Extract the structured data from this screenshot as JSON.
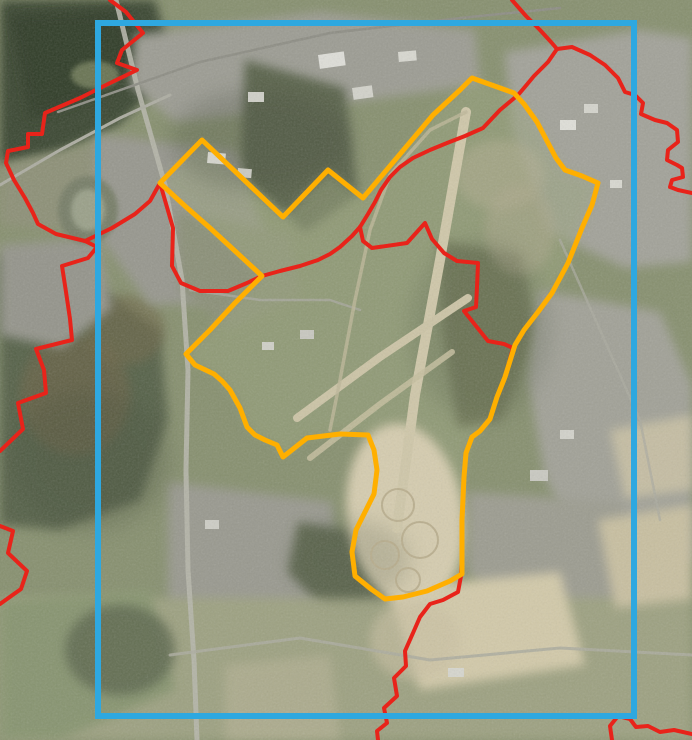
{
  "map": {
    "width": 692,
    "height": 740,
    "base_color": "#87906F",
    "palette": {
      "extent_frame_blue": "#2EA8E0",
      "site_boundary_orange": "#FFAF00",
      "municipal_boundary_red": "#E8231A"
    },
    "terrain_patches": [
      {
        "name": "water-lake",
        "kind": "polygon",
        "points": "0,0 155,0 168,45 150,95 118,125 60,152 0,165",
        "color": "#3A4733",
        "opacity": 1,
        "blur": "soft"
      },
      {
        "name": "water-dark",
        "kind": "polygon",
        "points": "10,15 120,10 140,60 100,95 30,120",
        "color": "#2E3A28",
        "opacity": 0.8,
        "blur": "soft"
      },
      {
        "name": "lake-island",
        "kind": "ellipse",
        "cx": 95,
        "cy": 75,
        "rx": 24,
        "ry": 14,
        "color": "#6F7A58",
        "opacity": 0.9,
        "blur": "slight"
      },
      {
        "name": "shore-strip",
        "kind": "polygon",
        "points": "0,165 70,150 130,135 180,160 150,215 60,230 0,225",
        "color": "#8D9077",
        "opacity": 1,
        "blur": "soft"
      },
      {
        "name": "forest-left",
        "kind": "polygon",
        "points": "0,255 95,285 160,330 168,420 140,500 60,530 0,525",
        "color": "#57624A",
        "opacity": 1,
        "blur": "soft"
      },
      {
        "name": "forest-left-brown",
        "kind": "ellipse",
        "cx": 75,
        "cy": 395,
        "rx": 55,
        "ry": 60,
        "color": "#6A6346",
        "opacity": 0.7,
        "blur": "soft"
      },
      {
        "name": "forest-left-brown-2",
        "kind": "ellipse",
        "cx": 125,
        "cy": 330,
        "rx": 40,
        "ry": 35,
        "color": "#70684A",
        "opacity": 0.6,
        "blur": "soft"
      },
      {
        "name": "industrial-top",
        "kind": "polygon",
        "points": "135,35 320,12 475,30 480,85 330,105 175,122 130,85",
        "color": "#9C9C93",
        "opacity": 1,
        "blur": "soft"
      },
      {
        "name": "town-top-right",
        "kind": "polygon",
        "points": "505,52 640,30 692,38 692,262 625,268 548,232 512,130",
        "color": "#A2A299",
        "opacity": 1,
        "blur": "soft"
      },
      {
        "name": "woods-center",
        "kind": "polygon",
        "points": "245,60 345,88 358,195 305,232 240,175",
        "color": "#5A644B",
        "opacity": 1,
        "blur": "soft"
      },
      {
        "name": "industrial-left-band",
        "kind": "polygon",
        "points": "95,135 235,150 265,235 235,302 150,305 98,235",
        "color": "#97978E",
        "opacity": 1,
        "blur": "soft"
      },
      {
        "name": "commercial-left-edge",
        "kind": "polygon",
        "points": "0,245 98,238 112,308 62,348 0,335",
        "color": "#94948B",
        "opacity": 1,
        "blur": "soft"
      },
      {
        "name": "oval-arena",
        "kind": "ellipse",
        "cx": 88,
        "cy": 210,
        "rx": 30,
        "ry": 34,
        "color": "#777E68",
        "opacity": 1,
        "blur": "slight"
      },
      {
        "name": "oval-arena-infield",
        "kind": "ellipse",
        "cx": 88,
        "cy": 210,
        "rx": 17,
        "ry": 21,
        "color": "#9AA089",
        "opacity": 1,
        "blur": "slight"
      },
      {
        "name": "barracks-area",
        "kind": "polygon",
        "points": "175,210 290,235 300,295 230,330 180,290",
        "color": "#8B9078",
        "opacity": 1,
        "blur": "soft"
      },
      {
        "name": "airfield-grass",
        "kind": "site-fill",
        "color": "#9AA47D",
        "opacity": 0.5,
        "blur": "soft"
      },
      {
        "name": "woods-east-strip",
        "kind": "polygon",
        "points": "438,240 520,255 538,330 502,420 458,428 442,330",
        "color": "#6F7757",
        "opacity": 0.85,
        "blur": "soft"
      },
      {
        "name": "clearing-ne",
        "kind": "ellipse",
        "cx": 500,
        "cy": 175,
        "rx": 45,
        "ry": 35,
        "color": "#B4AF92",
        "opacity": 0.5,
        "blur": "soft"
      },
      {
        "name": "clearing-ne-2",
        "kind": "ellipse",
        "cx": 520,
        "cy": 230,
        "rx": 35,
        "ry": 45,
        "color": "#ADA88C",
        "opacity": 0.5,
        "blur": "soft"
      },
      {
        "name": "suburb-east",
        "kind": "polygon",
        "points": "538,290 660,312 692,385 692,560 598,580 545,478 528,380",
        "color": "#A1A197",
        "opacity": 1,
        "blur": "soft"
      },
      {
        "name": "village-se",
        "kind": "polygon",
        "points": "468,492 622,502 640,598 520,628 468,572",
        "color": "#9C9C90",
        "opacity": 1,
        "blur": "soft"
      },
      {
        "name": "village-south",
        "kind": "polygon",
        "points": "168,482 332,502 342,640 228,662 168,602",
        "color": "#99998F",
        "opacity": 1,
        "blur": "soft"
      },
      {
        "name": "woods-south",
        "kind": "polygon",
        "points": "298,522 420,542 432,602 332,618 288,572",
        "color": "#5E684F",
        "opacity": 1,
        "blur": "soft"
      },
      {
        "name": "fields-bottom",
        "kind": "rect",
        "x": 0,
        "y": 598,
        "w": 692,
        "h": 142,
        "color": "#9DA181",
        "opacity": 1,
        "blur": "soft"
      },
      {
        "name": "field-pale-1",
        "kind": "polygon",
        "points": "388,588 560,572 585,665 420,690",
        "color": "#D2C9A9",
        "opacity": 1,
        "blur": "soft"
      },
      {
        "name": "field-pale-2",
        "kind": "polygon",
        "points": "598,520 692,505 692,600 615,608",
        "color": "#C8BFA0",
        "opacity": 1,
        "blur": "soft"
      },
      {
        "name": "field-pale-3",
        "kind": "polygon",
        "points": "610,430 692,415 692,490 625,498",
        "color": "#CEC5A6",
        "opacity": 0.8,
        "blur": "soft"
      },
      {
        "name": "field-green-bl",
        "kind": "polygon",
        "points": "0,600 150,590 175,690 60,740 0,740",
        "color": "#879470",
        "opacity": 1,
        "blur": "soft"
      },
      {
        "name": "woods-bl",
        "kind": "ellipse",
        "cx": 120,
        "cy": 650,
        "rx": 55,
        "ry": 45,
        "color": "#5C664D",
        "opacity": 0.8,
        "blur": "soft"
      },
      {
        "name": "field-pale-bl",
        "kind": "polygon",
        "points": "225,665 330,655 340,740 225,740",
        "color": "#B3B093",
        "opacity": 0.7,
        "blur": "soft"
      },
      {
        "name": "drop-zone",
        "kind": "ellipse",
        "cx": 405,
        "cy": 515,
        "rx": 58,
        "ry": 92,
        "rotate": -8,
        "color": "#D5CCAF",
        "opacity": 1,
        "blur": "soft"
      },
      {
        "name": "drop-zone-south",
        "kind": "ellipse",
        "cx": 415,
        "cy": 640,
        "rx": 45,
        "ry": 40,
        "color": "#C9C0A2",
        "opacity": 0.6,
        "blur": "soft"
      },
      {
        "name": "shade-top-center",
        "kind": "ellipse",
        "cx": 260,
        "cy": 140,
        "rx": 90,
        "ry": 50,
        "color": "#3C4534",
        "opacity": 0.25,
        "blur": "softer"
      },
      {
        "name": "shade-mid-east",
        "kind": "ellipse",
        "cx": 480,
        "cy": 330,
        "rx": 70,
        "ry": 90,
        "color": "#44503B",
        "opacity": 0.2,
        "blur": "softer"
      },
      {
        "name": "shade-left",
        "kind": "ellipse",
        "cx": 90,
        "cy": 460,
        "rx": 80,
        "ry": 70,
        "color": "#3F4936",
        "opacity": 0.25,
        "blur": "softer"
      },
      {
        "name": "shade-south",
        "kind": "ellipse",
        "cx": 350,
        "cy": 560,
        "rx": 60,
        "ry": 40,
        "color": "#454F3C",
        "opacity": 0.2,
        "blur": "softer"
      },
      {
        "name": "roof-1",
        "kind": "rect",
        "x": 318,
        "y": 55,
        "w": 26,
        "h": 14,
        "rotate": -8,
        "color": "#DEDED8",
        "opacity": 1,
        "blur": "none"
      },
      {
        "name": "roof-2",
        "kind": "rect",
        "x": 352,
        "y": 88,
        "w": 20,
        "h": 12,
        "rotate": -8,
        "color": "#D2D2CA",
        "opacity": 1,
        "blur": "none"
      },
      {
        "name": "roof-3",
        "kind": "rect",
        "x": 398,
        "y": 52,
        "w": 18,
        "h": 10,
        "rotate": -5,
        "color": "#D8D8D0",
        "opacity": 1,
        "blur": "none"
      },
      {
        "name": "roof-4",
        "kind": "rect",
        "x": 248,
        "y": 92,
        "w": 16,
        "h": 10,
        "rotate": 0,
        "color": "#CFCFC7",
        "opacity": 1,
        "blur": "none"
      },
      {
        "name": "roof-5",
        "kind": "rect",
        "x": 208,
        "y": 152,
        "w": 18,
        "h": 11,
        "rotate": 5,
        "color": "#D5D5CD",
        "opacity": 1,
        "blur": "none"
      },
      {
        "name": "roof-6",
        "kind": "rect",
        "x": 238,
        "y": 168,
        "w": 14,
        "h": 9,
        "rotate": 5,
        "color": "#CACAC2",
        "opacity": 1,
        "blur": "none"
      },
      {
        "name": "roof-7",
        "kind": "rect",
        "x": 560,
        "y": 120,
        "w": 16,
        "h": 10,
        "rotate": 0,
        "color": "#DFDFD8",
        "opacity": 1,
        "blur": "none"
      },
      {
        "name": "roof-8",
        "kind": "rect",
        "x": 584,
        "y": 104,
        "w": 14,
        "h": 9,
        "rotate": 0,
        "color": "#D4D4CC",
        "opacity": 1,
        "blur": "none"
      },
      {
        "name": "roof-9",
        "kind": "rect",
        "x": 300,
        "y": 330,
        "w": 14,
        "h": 9,
        "rotate": 0,
        "color": "#C8C8C0",
        "opacity": 1,
        "blur": "none"
      },
      {
        "name": "roof-10",
        "kind": "rect",
        "x": 262,
        "y": 342,
        "w": 12,
        "h": 8,
        "rotate": 0,
        "color": "#CFCFC7",
        "opacity": 1,
        "blur": "none"
      },
      {
        "name": "roof-11",
        "kind": "rect",
        "x": 530,
        "y": 470,
        "w": 18,
        "h": 11,
        "rotate": 0,
        "color": "#C9C9C1",
        "opacity": 1,
        "blur": "none"
      },
      {
        "name": "roof-12",
        "kind": "rect",
        "x": 560,
        "y": 430,
        "w": 14,
        "h": 9,
        "rotate": 0,
        "color": "#D2D2CA",
        "opacity": 1,
        "blur": "none"
      },
      {
        "name": "roof-13",
        "kind": "rect",
        "x": 610,
        "y": 180,
        "w": 12,
        "h": 8,
        "rotate": 0,
        "color": "#D8D8D0",
        "opacity": 1,
        "blur": "none"
      },
      {
        "name": "roof-14",
        "kind": "rect",
        "x": 205,
        "y": 520,
        "w": 14,
        "h": 9,
        "rotate": 0,
        "color": "#CDCDC5",
        "opacity": 1,
        "blur": "none"
      },
      {
        "name": "roof-15",
        "kind": "rect",
        "x": 448,
        "y": 668,
        "w": 16,
        "h": 9,
        "rotate": 0,
        "color": "#D6D6CE",
        "opacity": 1,
        "blur": "none"
      }
    ],
    "terrain_lines": [
      {
        "name": "motorway",
        "points": "116,0 138,90 165,185 182,280 188,370 186,470 188,570 194,660 197,740",
        "width": 5,
        "color": "#B6B6AA",
        "opacity": 0.9
      },
      {
        "name": "railway",
        "points": "58,112 200,62 330,33 470,17 560,8",
        "width": 2.5,
        "color": "#8E8E85",
        "opacity": 1
      },
      {
        "name": "road-left-diagonal",
        "points": "0,185 60,150 120,118 170,95",
        "width": 3,
        "color": "#ADADA2",
        "opacity": 1
      },
      {
        "name": "road-into-base",
        "points": "190,290 260,300 330,300 360,310",
        "width": 2.5,
        "color": "#A8A89D",
        "opacity": 0.8
      },
      {
        "name": "road-bottom",
        "points": "170,655 300,638 430,660 560,648 692,655",
        "width": 3,
        "color": "#ABAB9F",
        "opacity": 0.85
      },
      {
        "name": "road-right",
        "points": "560,240 600,330 640,420 660,520",
        "width": 2.5,
        "color": "#ABAB9F",
        "opacity": 0.7
      },
      {
        "name": "runway-main",
        "points": "466,112 440,260 415,395 397,528",
        "width": 10,
        "color": "#CFC7A9",
        "opacity": 1
      },
      {
        "name": "runway-cross",
        "points": "297,418 380,357 468,298",
        "width": 8,
        "color": "#CCC4A6",
        "opacity": 1
      },
      {
        "name": "runway-cross-2",
        "points": "310,458 380,404 452,352",
        "width": 6,
        "color": "#C5BE9F",
        "opacity": 0.85
      },
      {
        "name": "taxiway-west",
        "points": "466,112 430,130 390,175 370,230 355,300 340,380 330,430",
        "width": 3.5,
        "color": "#BDB698",
        "opacity": 0.8
      }
    ],
    "drop_pads": [
      {
        "name": "drop-pad-1",
        "cx": 398,
        "cy": 505,
        "r": 16
      },
      {
        "name": "drop-pad-2",
        "cx": 420,
        "cy": 540,
        "r": 18
      },
      {
        "name": "drop-pad-3",
        "cx": 385,
        "cy": 555,
        "r": 14
      },
      {
        "name": "drop-pad-4",
        "cx": 408,
        "cy": 580,
        "r": 12
      }
    ],
    "drop_pad_style": {
      "color": "#B7AC8C",
      "width": 2
    },
    "boundaries": {
      "municipal": {
        "name": "municipal-boundary-red",
        "color": "#E8231A",
        "width": 4,
        "segments": [
          "110,0 126,12 143,33 122,50 117,63 137,70 108,84 80,98 45,113 42,134 28,134 28,147 8,151 6,163 14,180 25,198 33,213 38,224 56,234 85,241",
          "85,241 97,247 88,258 62,266 66,292 70,319 72,340 36,349 44,370 46,393 18,403 23,429 0,451",
          "0,526 13,531 8,553 27,571 21,589 0,604",
          "85,241 112,228 135,214 150,201 160,183",
          "160,183 173,228 172,266 181,283 200,291 228,291 247,283 262,276",
          "262,276 280,271 300,266 318,260 330,254 340,247 352,236 360,227 368,214 375,202 381,190 390,177 400,167 413,158 430,150 447,143 465,136 483,128 500,110 518,95",
          "360,227 363,241 372,248 407,243 425,223 432,239 444,253 457,261 478,263 477,287 476,307 464,311 476,326 488,341 504,344 513,348",
          "513,348 505,377 497,397 490,419 480,431 472,437 466,453 464,477 462,520 462,552 461,576 458,592 443,600 430,604 420,617 413,633 405,651 406,666 394,678 397,696 384,708 387,723 377,731 378,740",
          "512,0 526,16 540,30 551,42 557,49 548,62 534,76 524,88 518,95",
          "557,49 572,47 590,55 605,65 618,78 625,92 635,95 643,103 641,114 655,120 667,123 677,130 678,142 668,150 667,160 677,165 682,168 683,177 672,180 670,187 678,190 692,193",
          "612,740 610,726 618,716 630,719 636,727 648,726 660,732 674,730 692,734"
        ]
      },
      "site": {
        "name": "airfield-site-boundary-orange",
        "color": "#FFAF00",
        "width": 5,
        "points": "472,78 514,93 524,104 537,122 547,141 556,158 565,170 582,176 598,183 592,205 582,228 568,263 552,293 538,312 524,330 515,345 505,377 497,397 490,419 480,431 472,437 466,453 464,477 462,520 462,552 462,574 450,581 427,591 403,597 385,599 371,589 355,576 352,552 356,530 366,510 374,494 377,470 374,450 368,435 340,434 307,438 283,457 277,445 265,440 255,435 247,427 240,408 230,390 222,381 214,374 195,365 186,354 210,330 235,303 250,288 262,276 235,251 210,228 185,206 160,183 202,140 283,217 328,170 363,198 433,115 460,90"
      },
      "extent_frame": {
        "name": "map-extent-frame-blue",
        "color": "#2EA8E0",
        "width": 6,
        "x": 98,
        "y": 23,
        "w": 536,
        "h": 693
      }
    }
  }
}
